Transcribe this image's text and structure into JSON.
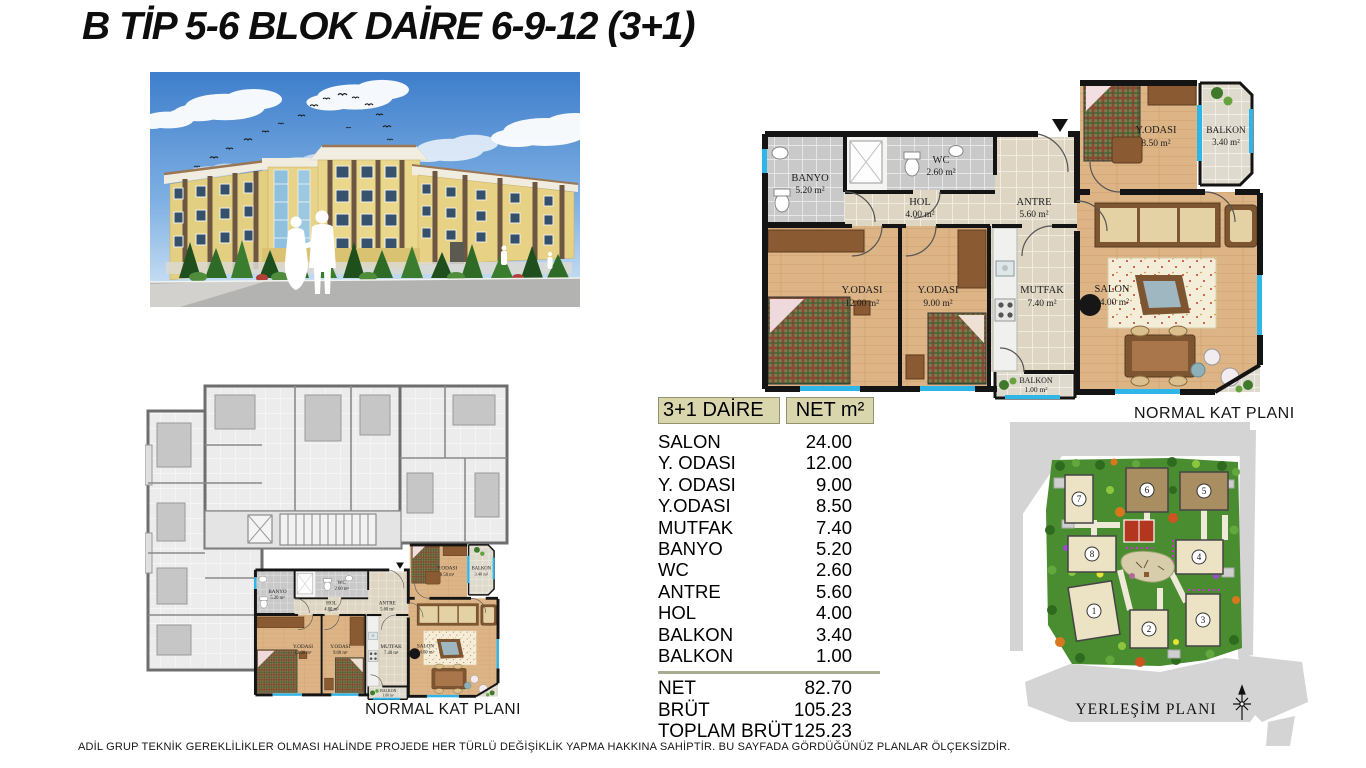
{
  "page": {
    "title": "B TİP 5-6 BLOK DAİRE 6-9-12 (3+1)",
    "footer": "ADİL GRUP TEKNİK GEREKLİLİKLER OLMASI HALİNDE PROJEDE HER TÜRLÜ DEĞİŞİKLİK YAPMA HAKKINA SAHİPTİR. BU SAYFADA GÖRDÜĞÜNÜZ PLANLAR ÖLÇEKSİZDİR."
  },
  "table": {
    "header": {
      "col1": "3+1 DAİRE",
      "col2": "NET m²"
    },
    "rows": [
      {
        "label": "SALON",
        "value": "24.00"
      },
      {
        "label": "Y. ODASI",
        "value": "12.00"
      },
      {
        "label": "Y. ODASI",
        "value": "9.00"
      },
      {
        "label": "Y.ODASI",
        "value": "8.50"
      },
      {
        "label": "MUTFAK",
        "value": "7.40"
      },
      {
        "label": "BANYO",
        "value": "5.20"
      },
      {
        "label": "WC",
        "value": "2.60"
      },
      {
        "label": "ANTRE",
        "value": "5.60"
      },
      {
        "label": "HOL",
        "value": "4.00"
      },
      {
        "label": "BALKON",
        "value": "3.40"
      },
      {
        "label": "BALKON",
        "value": "1.00"
      }
    ],
    "totals": [
      {
        "label": "NET",
        "value": "82.70"
      },
      {
        "label": "BRÜT",
        "value": "105.23"
      },
      {
        "label": "TOPLAM BRÜT",
        "value": "125.23"
      }
    ]
  },
  "unit": {
    "caption": "NORMAL KAT PLANI",
    "rooms": [
      {
        "name": "BANYO",
        "area": "5.20 m²"
      },
      {
        "name": "WC",
        "area": "2.60 m²"
      },
      {
        "name": "HOL",
        "area": "4.00 m²"
      },
      {
        "name": "ANTRE",
        "area": "5.60 m²"
      },
      {
        "name": "Y.ODASI",
        "area": "12.00 m²"
      },
      {
        "name": "Y.ODASI",
        "area": "9.00 m²"
      },
      {
        "name": "MUTFAK",
        "area": "7.40 m²"
      },
      {
        "name": "SALON",
        "area": "24.00 m²"
      },
      {
        "name": "Y.ODASI",
        "area": "8.50 m²"
      },
      {
        "name": "BALKON",
        "area": "3.40 m²"
      },
      {
        "name": "BALKON",
        "area": "1.00 m²"
      }
    ]
  },
  "siteplan": {
    "caption": "YERLEŞİM PLANI",
    "buildings": [
      "1",
      "2",
      "3",
      "4",
      "5",
      "6",
      "7",
      "8"
    ]
  },
  "colors": {
    "wood_floor": "#dcb486",
    "tile_beige": "#ded6c3",
    "tile_gray": "#c9c9c9",
    "wall_black": "#141414",
    "window_cyan": "#2fb6e8",
    "table_header_bg": "#d9d6ae",
    "site_green": "#4a8c30",
    "building_cream": "#ece2c4",
    "building_brown": "#a98e62",
    "court_red": "#b3371f",
    "road_gray": "#d4d4d4",
    "facade_yellow": "#e8d589"
  }
}
